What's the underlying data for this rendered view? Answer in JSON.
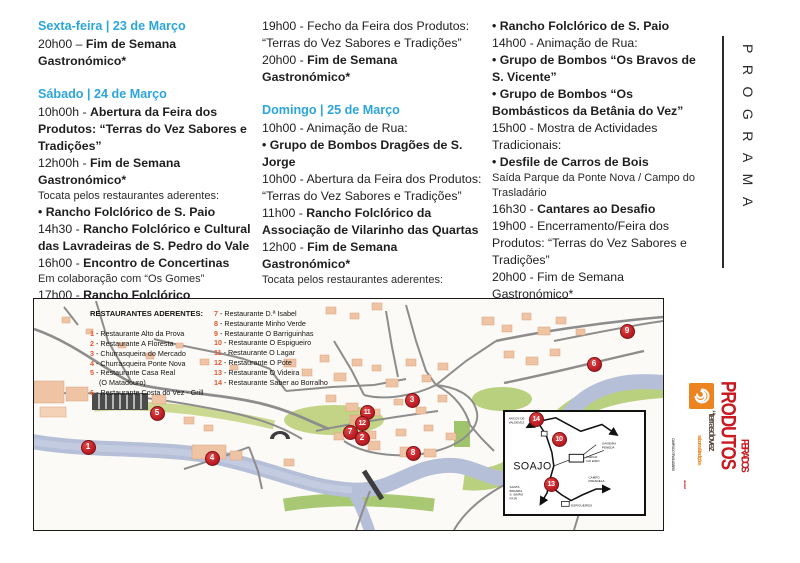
{
  "programa_vertical": "PROGRAMA",
  "program": {
    "columns": [
      {
        "blocks": [
          {
            "type": "heading",
            "text": "Sexta-feira | 23 de Março"
          },
          {
            "type": "line",
            "segments": [
              {
                "text": "20h00 – ",
                "bold": false
              },
              {
                "text": "Fim de Semana Gastronómico*",
                "bold": true
              }
            ]
          },
          {
            "type": "spacer"
          },
          {
            "type": "heading",
            "text": "Sábado | 24 de Março"
          },
          {
            "type": "line",
            "segments": [
              {
                "text": "10h00h - ",
                "bold": false
              },
              {
                "text": "Abertura da Feira dos Produtos: “Terras do Vez Sabores e Tradições”",
                "bold": true
              }
            ]
          },
          {
            "type": "line",
            "segments": [
              {
                "text": "12h00h - ",
                "bold": false
              },
              {
                "text": "Fim de Semana Gastronómico*",
                "bold": true
              }
            ]
          },
          {
            "type": "note",
            "text": "Tocata pelos restaurantes aderentes:"
          },
          {
            "type": "line",
            "segments": [
              {
                "text": "• Rancho Folclórico de S. Paio",
                "bold": true
              }
            ]
          },
          {
            "type": "line",
            "segments": [
              {
                "text": "14h30 - ",
                "bold": false
              },
              {
                "text": "Rancho Folclórico e Cultural das Lavradeiras de S. Pedro do Vale",
                "bold": true
              }
            ]
          },
          {
            "type": "line",
            "segments": [
              {
                "text": "16h00 - ",
                "bold": false
              },
              {
                "text": "Encontro de Concertinas",
                "bold": true
              }
            ]
          },
          {
            "type": "note",
            "text": "Em colaboração com “Os Gomes”"
          },
          {
            "type": "line",
            "segments": [
              {
                "text": "17h00 - ",
                "bold": false
              },
              {
                "text": "Rancho Folclórico",
                "bold": true
              }
            ]
          }
        ]
      },
      {
        "blocks": [
          {
            "type": "line",
            "segments": [
              {
                "text": "19h00 - Fecho da Feira dos Produtos: “Terras do Vez Sabores e Tradições”",
                "bold": false
              }
            ]
          },
          {
            "type": "line",
            "segments": [
              {
                "text": "20h00 - ",
                "bold": false
              },
              {
                "text": "Fim de Semana Gastronómico*",
                "bold": true
              }
            ]
          },
          {
            "type": "spacer"
          },
          {
            "type": "heading",
            "text": "Domingo | 25 de Março"
          },
          {
            "type": "line",
            "segments": [
              {
                "text": "10h00 - Animação de Rua:",
                "bold": false
              }
            ]
          },
          {
            "type": "line",
            "segments": [
              {
                "text": "• Grupo de Bombos Dragões de S. Jorge",
                "bold": true
              }
            ]
          },
          {
            "type": "line",
            "segments": [
              {
                "text": "10h00 - Abertura da Feira dos Produtos: “Terras do Vez Sabores e Tradições”",
                "bold": false
              }
            ]
          },
          {
            "type": "line",
            "segments": [
              {
                "text": "11h00 - ",
                "bold": false
              },
              {
                "text": "Rancho Folclórico da Associação de Vilarinho das Quartas",
                "bold": true
              }
            ]
          },
          {
            "type": "line",
            "segments": [
              {
                "text": "12h00 - ",
                "bold": false
              },
              {
                "text": "Fim de Semana Gastronómico*",
                "bold": true
              }
            ]
          },
          {
            "type": "note",
            "text": "Tocata pelos restaurantes aderentes:"
          }
        ]
      },
      {
        "blocks": [
          {
            "type": "line",
            "segments": [
              {
                "text": "• Rancho Folclórico de S. Paio",
                "bold": true
              }
            ]
          },
          {
            "type": "line",
            "segments": [
              {
                "text": "14h00 - Animação de Rua:",
                "bold": false
              }
            ]
          },
          {
            "type": "line",
            "segments": [
              {
                "text": "• Grupo de Bombos “Os Bravos de S. Vicente”",
                "bold": true
              }
            ]
          },
          {
            "type": "line",
            "segments": [
              {
                "text": "• Grupo de Bombos “Os Bombásticos da Betânia do Vez”",
                "bold": true
              }
            ]
          },
          {
            "type": "line",
            "segments": [
              {
                "text": "15h00 - Mostra de Actividades Tradicionais:",
                "bold": false
              }
            ]
          },
          {
            "type": "line",
            "segments": [
              {
                "text": "• Desfile de Carros de Bois",
                "bold": true
              }
            ]
          },
          {
            "type": "note",
            "text": "Saída Parque da Ponte Nova / Campo do Trasladário"
          },
          {
            "type": "line",
            "segments": [
              {
                "text": "16h30 - ",
                "bold": false
              },
              {
                "text": "Cantares ao Desafio",
                "bold": true
              }
            ]
          },
          {
            "type": "line",
            "segments": [
              {
                "text": "19h00 - Encerramento/Feira dos Produtos: “Terras do Vez Sabores e Tradições”",
                "bold": false
              }
            ]
          },
          {
            "type": "line",
            "segments": [
              {
                "text": "20h00 - Fim de Semana Gastronómico*",
                "bold": false
              }
            ]
          },
          {
            "type": "note",
            "text": "* Restaurantes aderentes"
          }
        ]
      }
    ]
  },
  "legend": {
    "title": "RESTAURANTES ADERENTES:",
    "col1": [
      {
        "num": "1",
        "lines": [
          "Restaurante Alto da Prova"
        ]
      },
      {
        "num": "2",
        "lines": [
          "Restaurante A Floresta"
        ]
      },
      {
        "num": "3",
        "lines": [
          "Churrasqueira do Mercado"
        ]
      },
      {
        "num": "4",
        "lines": [
          "Churrasqueira Ponte Nova"
        ]
      },
      {
        "num": "5",
        "lines": [
          "Restaurante Casa Real",
          "(O Matadouro)"
        ]
      },
      {
        "num": "6",
        "lines": [
          "Restaurante Costa do Vez - Grill"
        ]
      }
    ],
    "col2": [
      {
        "num": "7",
        "lines": [
          "Restaurante D.ª Isabel"
        ]
      },
      {
        "num": "8",
        "lines": [
          "Restaurante Minho Verde"
        ]
      },
      {
        "num": "9",
        "lines": [
          "Restaurante O Barriguinhas"
        ]
      },
      {
        "num": "10",
        "lines": [
          "Restaurante O Espigueiro"
        ]
      },
      {
        "num": "11",
        "lines": [
          "Restaurante O Lagar"
        ]
      },
      {
        "num": "12",
        "lines": [
          "Restaurante O Pote"
        ]
      },
      {
        "num": "13",
        "lines": [
          "Restaurante O Videira"
        ]
      },
      {
        "num": "14",
        "lines": [
          "Restaurante Saber ao Borralho"
        ]
      }
    ]
  },
  "map": {
    "markers": [
      {
        "n": "1",
        "x": 54,
        "y": 148
      },
      {
        "n": "5",
        "x": 123,
        "y": 114
      },
      {
        "n": "4",
        "x": 178,
        "y": 159
      },
      {
        "n": "11",
        "x": 333,
        "y": 113
      },
      {
        "n": "12",
        "x": 328,
        "y": 124
      },
      {
        "n": "7",
        "x": 316,
        "y": 133
      },
      {
        "n": "2",
        "x": 328,
        "y": 139
      },
      {
        "n": "3",
        "x": 378,
        "y": 101
      },
      {
        "n": "8",
        "x": 379,
        "y": 154
      },
      {
        "n": "6",
        "x": 560,
        "y": 65
      },
      {
        "n": "9",
        "x": 593,
        "y": 32
      },
      {
        "n": "14",
        "x": 502,
        "y": 120
      },
      {
        "n": "10",
        "x": 525,
        "y": 140
      },
      {
        "n": "13",
        "x": 517,
        "y": 185
      }
    ],
    "inset": {
      "town": "SOAJO",
      "arcos": [
        "ARCOS DE",
        "VALDEVEZ"
      ],
      "gavieira": [
        "GAVIEIRA",
        "PENEDA"
      ],
      "largo": [
        "LARGO",
        "DO EIRO"
      ],
      "campo": [
        "CAMPO",
        "PARADELA"
      ],
      "espigueiros": "ESPIGUEIROS",
      "southwest": [
        "SANTA",
        "BRANDA",
        "S. SIMÃO",
        "FAJÃ"
      ]
    }
  },
  "logo": {
    "feira_dos": "FEIRA DOS",
    "produtos": "PRODUTOS",
    "terras": "“terrasdovez",
    "sabores": "sabores&tradições",
    "slow": "slow food",
    "campo": "CAMPO DO TRASLADÁRIO"
  },
  "colors": {
    "heading_blue": "#2ca5dc",
    "legend_orange": "#e2572f",
    "marker_red": "#c22128",
    "logo_red": "#c81a20",
    "logo_orange": "#ee8420",
    "river_blue": "#b5bfd7"
  }
}
